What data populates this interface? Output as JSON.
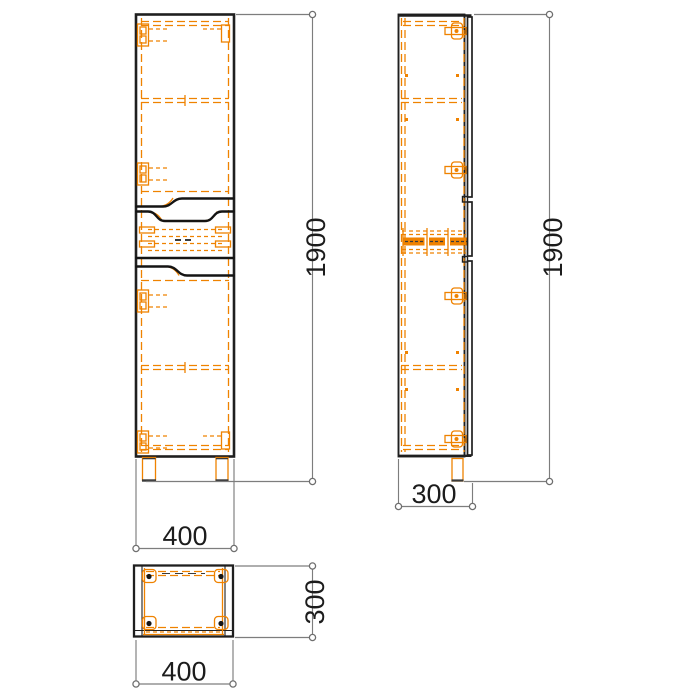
{
  "drawing": {
    "colors": {
      "outline": "#1f1f1f",
      "hidden_detail_orange": "#ef8200",
      "dimension_gray": "#7d7d7d",
      "label_text": "#1c1c1c",
      "background": "#ffffff"
    },
    "dimensions": {
      "front": {
        "height": "1900",
        "width": "400"
      },
      "side": {
        "height": "1900",
        "depth": "300"
      },
      "top": {
        "width": "400",
        "depth": "300"
      }
    }
  }
}
